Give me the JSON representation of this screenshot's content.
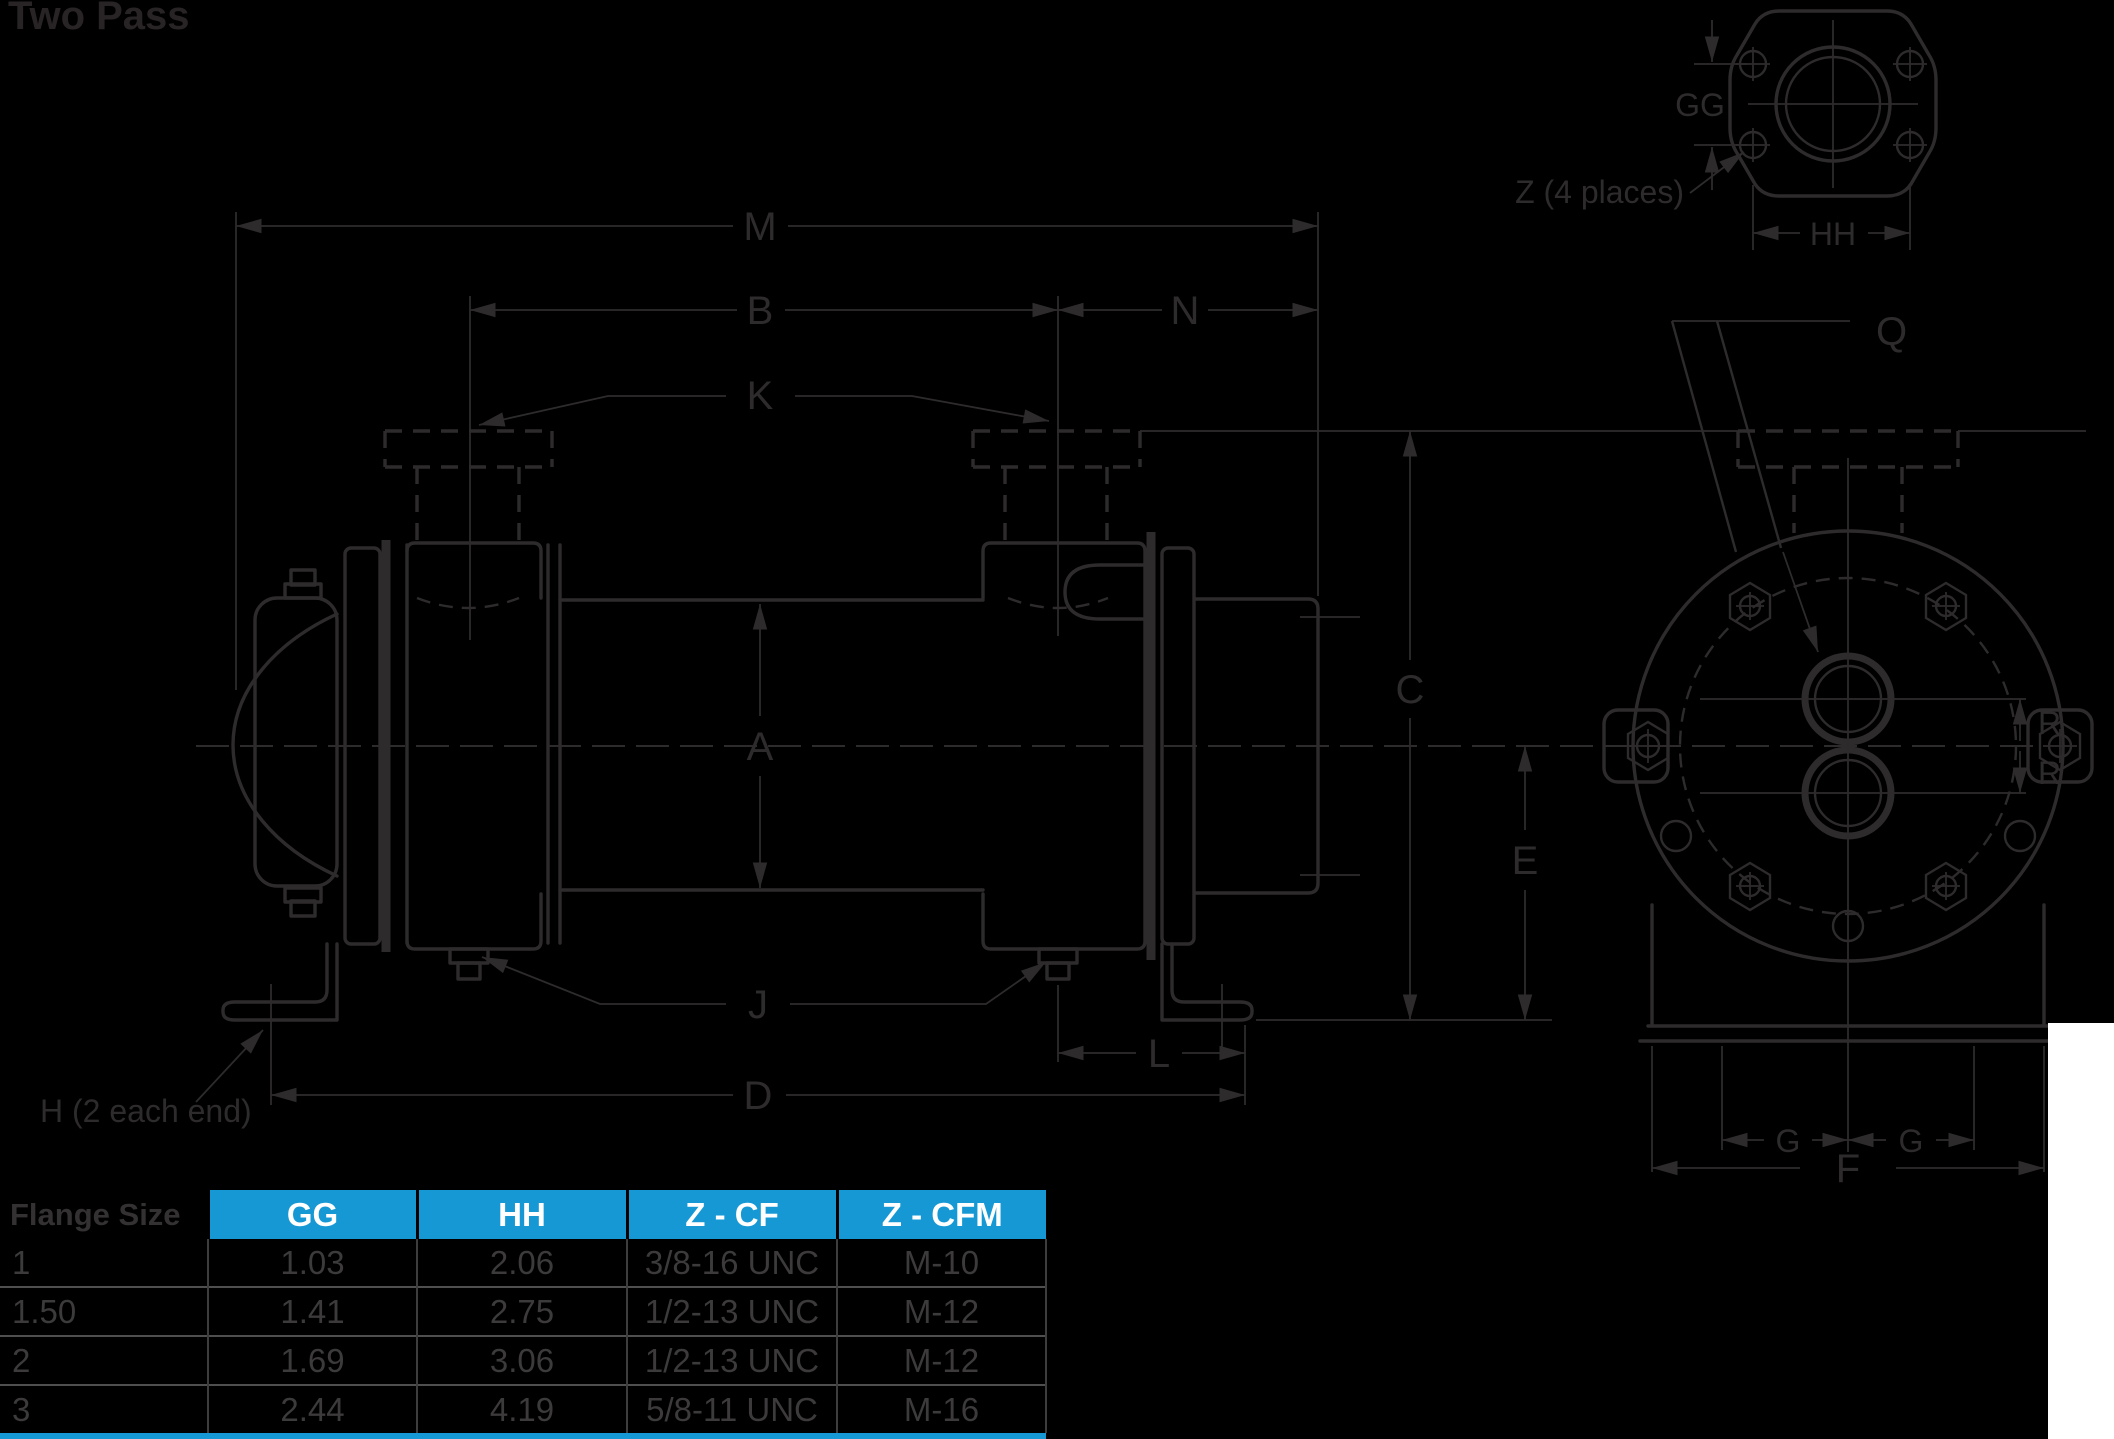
{
  "title": "Two Pass",
  "colors": {
    "background": "#000000",
    "line": "#2e2b2c",
    "title_text": "#282425",
    "accent_blue": "#1598d4",
    "table_header_text": "#ffffff",
    "table_body_text": "#3c3a3b",
    "row_separator": "#4f4f4f",
    "col_separator": "#3d3d3d",
    "white_patch": "#ffffff"
  },
  "drawing": {
    "labels": {
      "m": "M",
      "b": "B",
      "n": "N",
      "k": "K",
      "a": "A",
      "c": "C",
      "e": "E",
      "j": "J",
      "l": "L",
      "d": "D",
      "q": "Q",
      "f": "F",
      "r_top": "R",
      "r_bottom": "R",
      "g_left": "G",
      "g_right": "G",
      "gg": "GG",
      "hh": "HH"
    },
    "notes": {
      "h_note": "H (2 each end)",
      "z_note": "Z (4 places)"
    }
  },
  "table": {
    "row_header_label": "Flange Size",
    "columns": [
      "GG",
      "HH",
      "Z - CF",
      "Z - CFM"
    ],
    "rows": [
      {
        "flange_size": "1",
        "gg": "1.03",
        "hh": "2.06",
        "z_cf": "3/8-16 UNC",
        "z_cfm": "M-10"
      },
      {
        "flange_size": "1.50",
        "gg": "1.41",
        "hh": "2.75",
        "z_cf": "1/2-13 UNC",
        "z_cfm": "M-12"
      },
      {
        "flange_size": "2",
        "gg": "1.69",
        "hh": "3.06",
        "z_cf": "1/2-13 UNC",
        "z_cfm": "M-12"
      },
      {
        "flange_size": "3",
        "gg": "2.44",
        "hh": "4.19",
        "z_cf": "5/8-11 UNC",
        "z_cfm": "M-16"
      }
    ]
  }
}
